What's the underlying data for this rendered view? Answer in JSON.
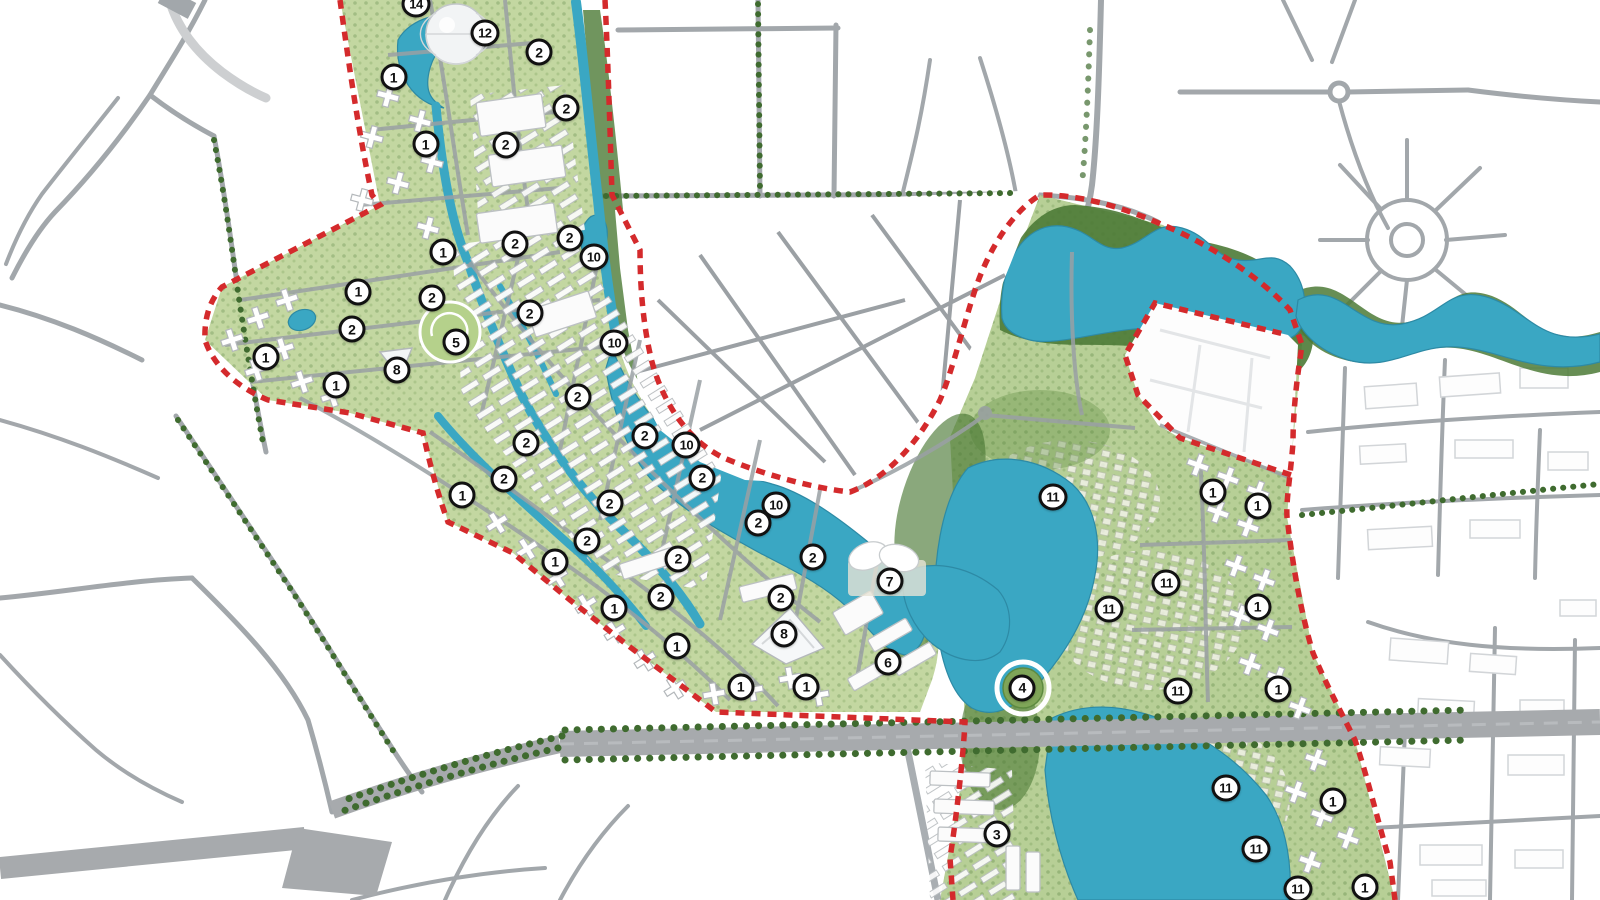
{
  "map": {
    "name": "urban-masterplan-map",
    "description": "Rendered master plan of a lakeside urban development with numbered parcel markers, red dashed project boundary, canals, lakes and surrounding city road context",
    "boundary_style": "red-dashed",
    "landmarks": [
      {
        "name": "geodesic-dome-pavilion",
        "zone": "12"
      },
      {
        "name": "lotus-flower-building",
        "zone": "7"
      },
      {
        "name": "v-shaped-exhibition-center",
        "zone": "8"
      },
      {
        "name": "circular-central-park",
        "zone": "5"
      },
      {
        "name": "lake-island",
        "zone": "4"
      },
      {
        "name": "future-development-parcel",
        "zone": "white-dashed-outline"
      }
    ],
    "theme": {
      "water": "#3aa7c3",
      "water-edge": "#2d8aa5",
      "green": "#c3d7a1",
      "green-ne": "#b7cf96",
      "forest": "#4c7a36",
      "tree": "#3f6b2f",
      "park": "#b5d18b",
      "road": "#9ba0a4",
      "road-light": "#aeb2b6",
      "hwy": "#a7aaad",
      "bld-stroke": "#bcc0c3",
      "ctx-bld": "#d2d5d8",
      "red": "#d42a2c",
      "ink": "#111"
    }
  },
  "markers": [
    {
      "label": "14",
      "x": 26.0,
      "y": 0.4
    },
    {
      "label": "12",
      "x": 30.3,
      "y": 3.7
    },
    {
      "label": "2",
      "x": 33.7,
      "y": 5.8
    },
    {
      "label": "1",
      "x": 24.6,
      "y": 8.6
    },
    {
      "label": "2",
      "x": 35.4,
      "y": 12.0
    },
    {
      "label": "1",
      "x": 26.6,
      "y": 16.0
    },
    {
      "label": "2",
      "x": 31.6,
      "y": 16.1
    },
    {
      "label": "1",
      "x": 27.7,
      "y": 28.0
    },
    {
      "label": "2",
      "x": 32.2,
      "y": 27.1
    },
    {
      "label": "2",
      "x": 35.6,
      "y": 26.4
    },
    {
      "label": "10",
      "x": 37.1,
      "y": 28.6
    },
    {
      "label": "1",
      "x": 22.4,
      "y": 32.4
    },
    {
      "label": "2",
      "x": 27.0,
      "y": 33.1
    },
    {
      "label": "2",
      "x": 33.1,
      "y": 34.8
    },
    {
      "label": "2",
      "x": 22.0,
      "y": 36.6
    },
    {
      "label": "5",
      "x": 28.5,
      "y": 38.0
    },
    {
      "label": "10",
      "x": 38.4,
      "y": 38.1
    },
    {
      "label": "1",
      "x": 16.6,
      "y": 39.7
    },
    {
      "label": "8",
      "x": 24.8,
      "y": 41.1
    },
    {
      "label": "1",
      "x": 21.0,
      "y": 42.8
    },
    {
      "label": "2",
      "x": 36.1,
      "y": 44.1
    },
    {
      "label": "2",
      "x": 40.3,
      "y": 48.4
    },
    {
      "label": "10",
      "x": 42.9,
      "y": 49.4
    },
    {
      "label": "2",
      "x": 32.9,
      "y": 49.2
    },
    {
      "label": "2",
      "x": 43.9,
      "y": 53.1
    },
    {
      "label": "2",
      "x": 31.5,
      "y": 53.2
    },
    {
      "label": "1",
      "x": 28.9,
      "y": 55.0
    },
    {
      "label": "2",
      "x": 38.1,
      "y": 55.9
    },
    {
      "label": "10",
      "x": 48.5,
      "y": 56.1
    },
    {
      "label": "2",
      "x": 47.4,
      "y": 58.1
    },
    {
      "label": "2",
      "x": 36.7,
      "y": 60.1
    },
    {
      "label": "2",
      "x": 50.8,
      "y": 61.9
    },
    {
      "label": "1",
      "x": 34.7,
      "y": 62.4
    },
    {
      "label": "2",
      "x": 42.4,
      "y": 62.1
    },
    {
      "label": "7",
      "x": 55.6,
      "y": 64.6
    },
    {
      "label": "2",
      "x": 41.3,
      "y": 66.3
    },
    {
      "label": "2",
      "x": 48.8,
      "y": 66.4
    },
    {
      "label": "1",
      "x": 38.4,
      "y": 67.6
    },
    {
      "label": "8",
      "x": 49.0,
      "y": 70.4
    },
    {
      "label": "1",
      "x": 42.3,
      "y": 71.8
    },
    {
      "label": "6",
      "x": 55.5,
      "y": 73.6
    },
    {
      "label": "1",
      "x": 46.3,
      "y": 76.3
    },
    {
      "label": "1",
      "x": 50.4,
      "y": 76.3
    },
    {
      "label": "11",
      "x": 65.8,
      "y": 55.2
    },
    {
      "label": "1",
      "x": 75.8,
      "y": 54.7
    },
    {
      "label": "1",
      "x": 78.6,
      "y": 56.2
    },
    {
      "label": "11",
      "x": 72.9,
      "y": 64.8
    },
    {
      "label": "11",
      "x": 69.3,
      "y": 67.7
    },
    {
      "label": "1",
      "x": 78.6,
      "y": 67.4
    },
    {
      "label": "4",
      "x": 63.9,
      "y": 76.4
    },
    {
      "label": "11",
      "x": 73.6,
      "y": 76.8
    },
    {
      "label": "1",
      "x": 79.9,
      "y": 76.6
    },
    {
      "label": "11",
      "x": 76.6,
      "y": 87.6
    },
    {
      "label": "1",
      "x": 83.3,
      "y": 89.0
    },
    {
      "label": "3",
      "x": 62.3,
      "y": 92.7
    },
    {
      "label": "11",
      "x": 78.5,
      "y": 94.3
    },
    {
      "label": "11",
      "x": 81.1,
      "y": 98.8
    },
    {
      "label": "1",
      "x": 85.3,
      "y": 98.6
    }
  ]
}
